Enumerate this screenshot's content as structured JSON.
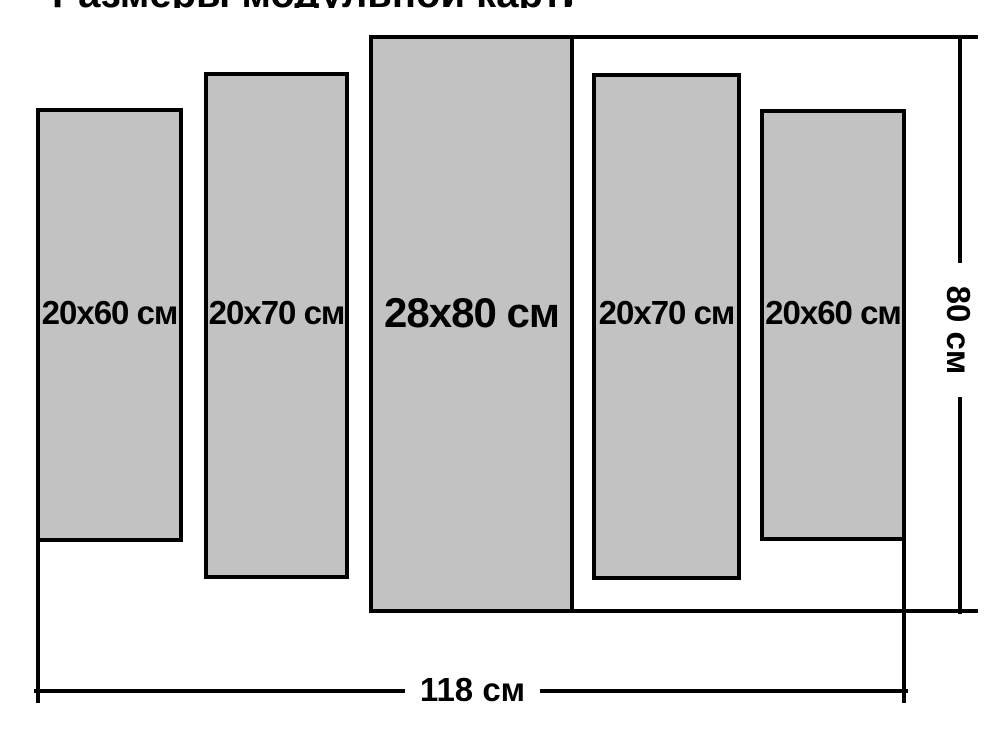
{
  "clipped_top_text": "Размеры модульной картины",
  "panels": [
    {
      "label": "20x60 см",
      "width_cm": 20,
      "height_cm": 60
    },
    {
      "label": "20x70 см",
      "width_cm": 20,
      "height_cm": 70
    },
    {
      "label": "28x80 см",
      "width_cm": 28,
      "height_cm": 80
    },
    {
      "label": "20x70 см",
      "width_cm": 20,
      "height_cm": 70
    },
    {
      "label": "20x60 см",
      "width_cm": 20,
      "height_cm": 60
    }
  ],
  "dimension_labels": {
    "total_width": "118 см",
    "total_height": "80 см"
  },
  "colors": {
    "background": "#ffffff",
    "panel_fill": "#c2c2c2",
    "panel_border": "#000000",
    "dimension_line": "#000000",
    "text": "#000000"
  }
}
